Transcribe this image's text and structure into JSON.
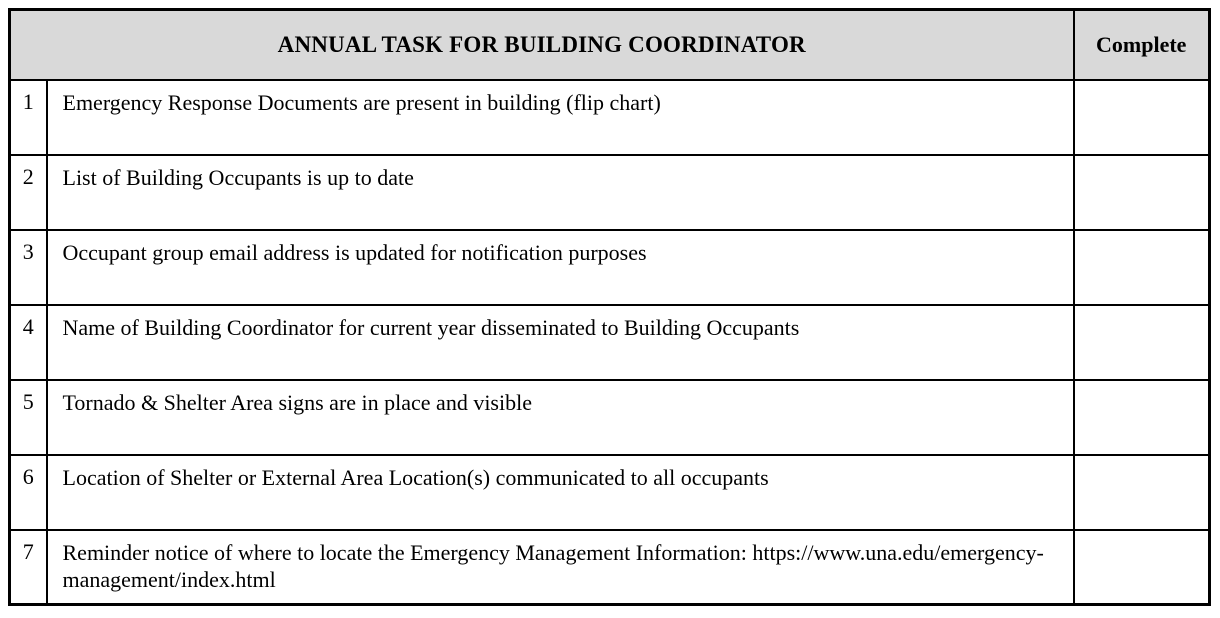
{
  "table": {
    "title": "ANNUAL TASK FOR BUILDING COORDINATOR",
    "complete_header": "Complete",
    "rows": [
      {
        "num": "1",
        "task": "Emergency Response Documents are present in building (flip chart)",
        "complete": ""
      },
      {
        "num": "2",
        "task": "List of Building Occupants is up to date",
        "complete": ""
      },
      {
        "num": "3",
        "task": "Occupant group email address is updated for notification purposes",
        "complete": ""
      },
      {
        "num": "4",
        "task": "Name of Building Coordinator for current year disseminated to Building Occupants",
        "complete": ""
      },
      {
        "num": "5",
        "task": "Tornado & Shelter Area signs are in place and visible",
        "complete": ""
      },
      {
        "num": "6",
        "task": "Location of Shelter or External Area Location(s) communicated to all occupants",
        "complete": ""
      },
      {
        "num": "7",
        "task": "Reminder notice of where to locate the Emergency Management Information: https://www.una.edu/emergency-management/index.html",
        "complete": ""
      }
    ],
    "colors": {
      "header_bg": "#d9d9d9",
      "border": "#000000",
      "page_bg": "#ffffff"
    }
  }
}
